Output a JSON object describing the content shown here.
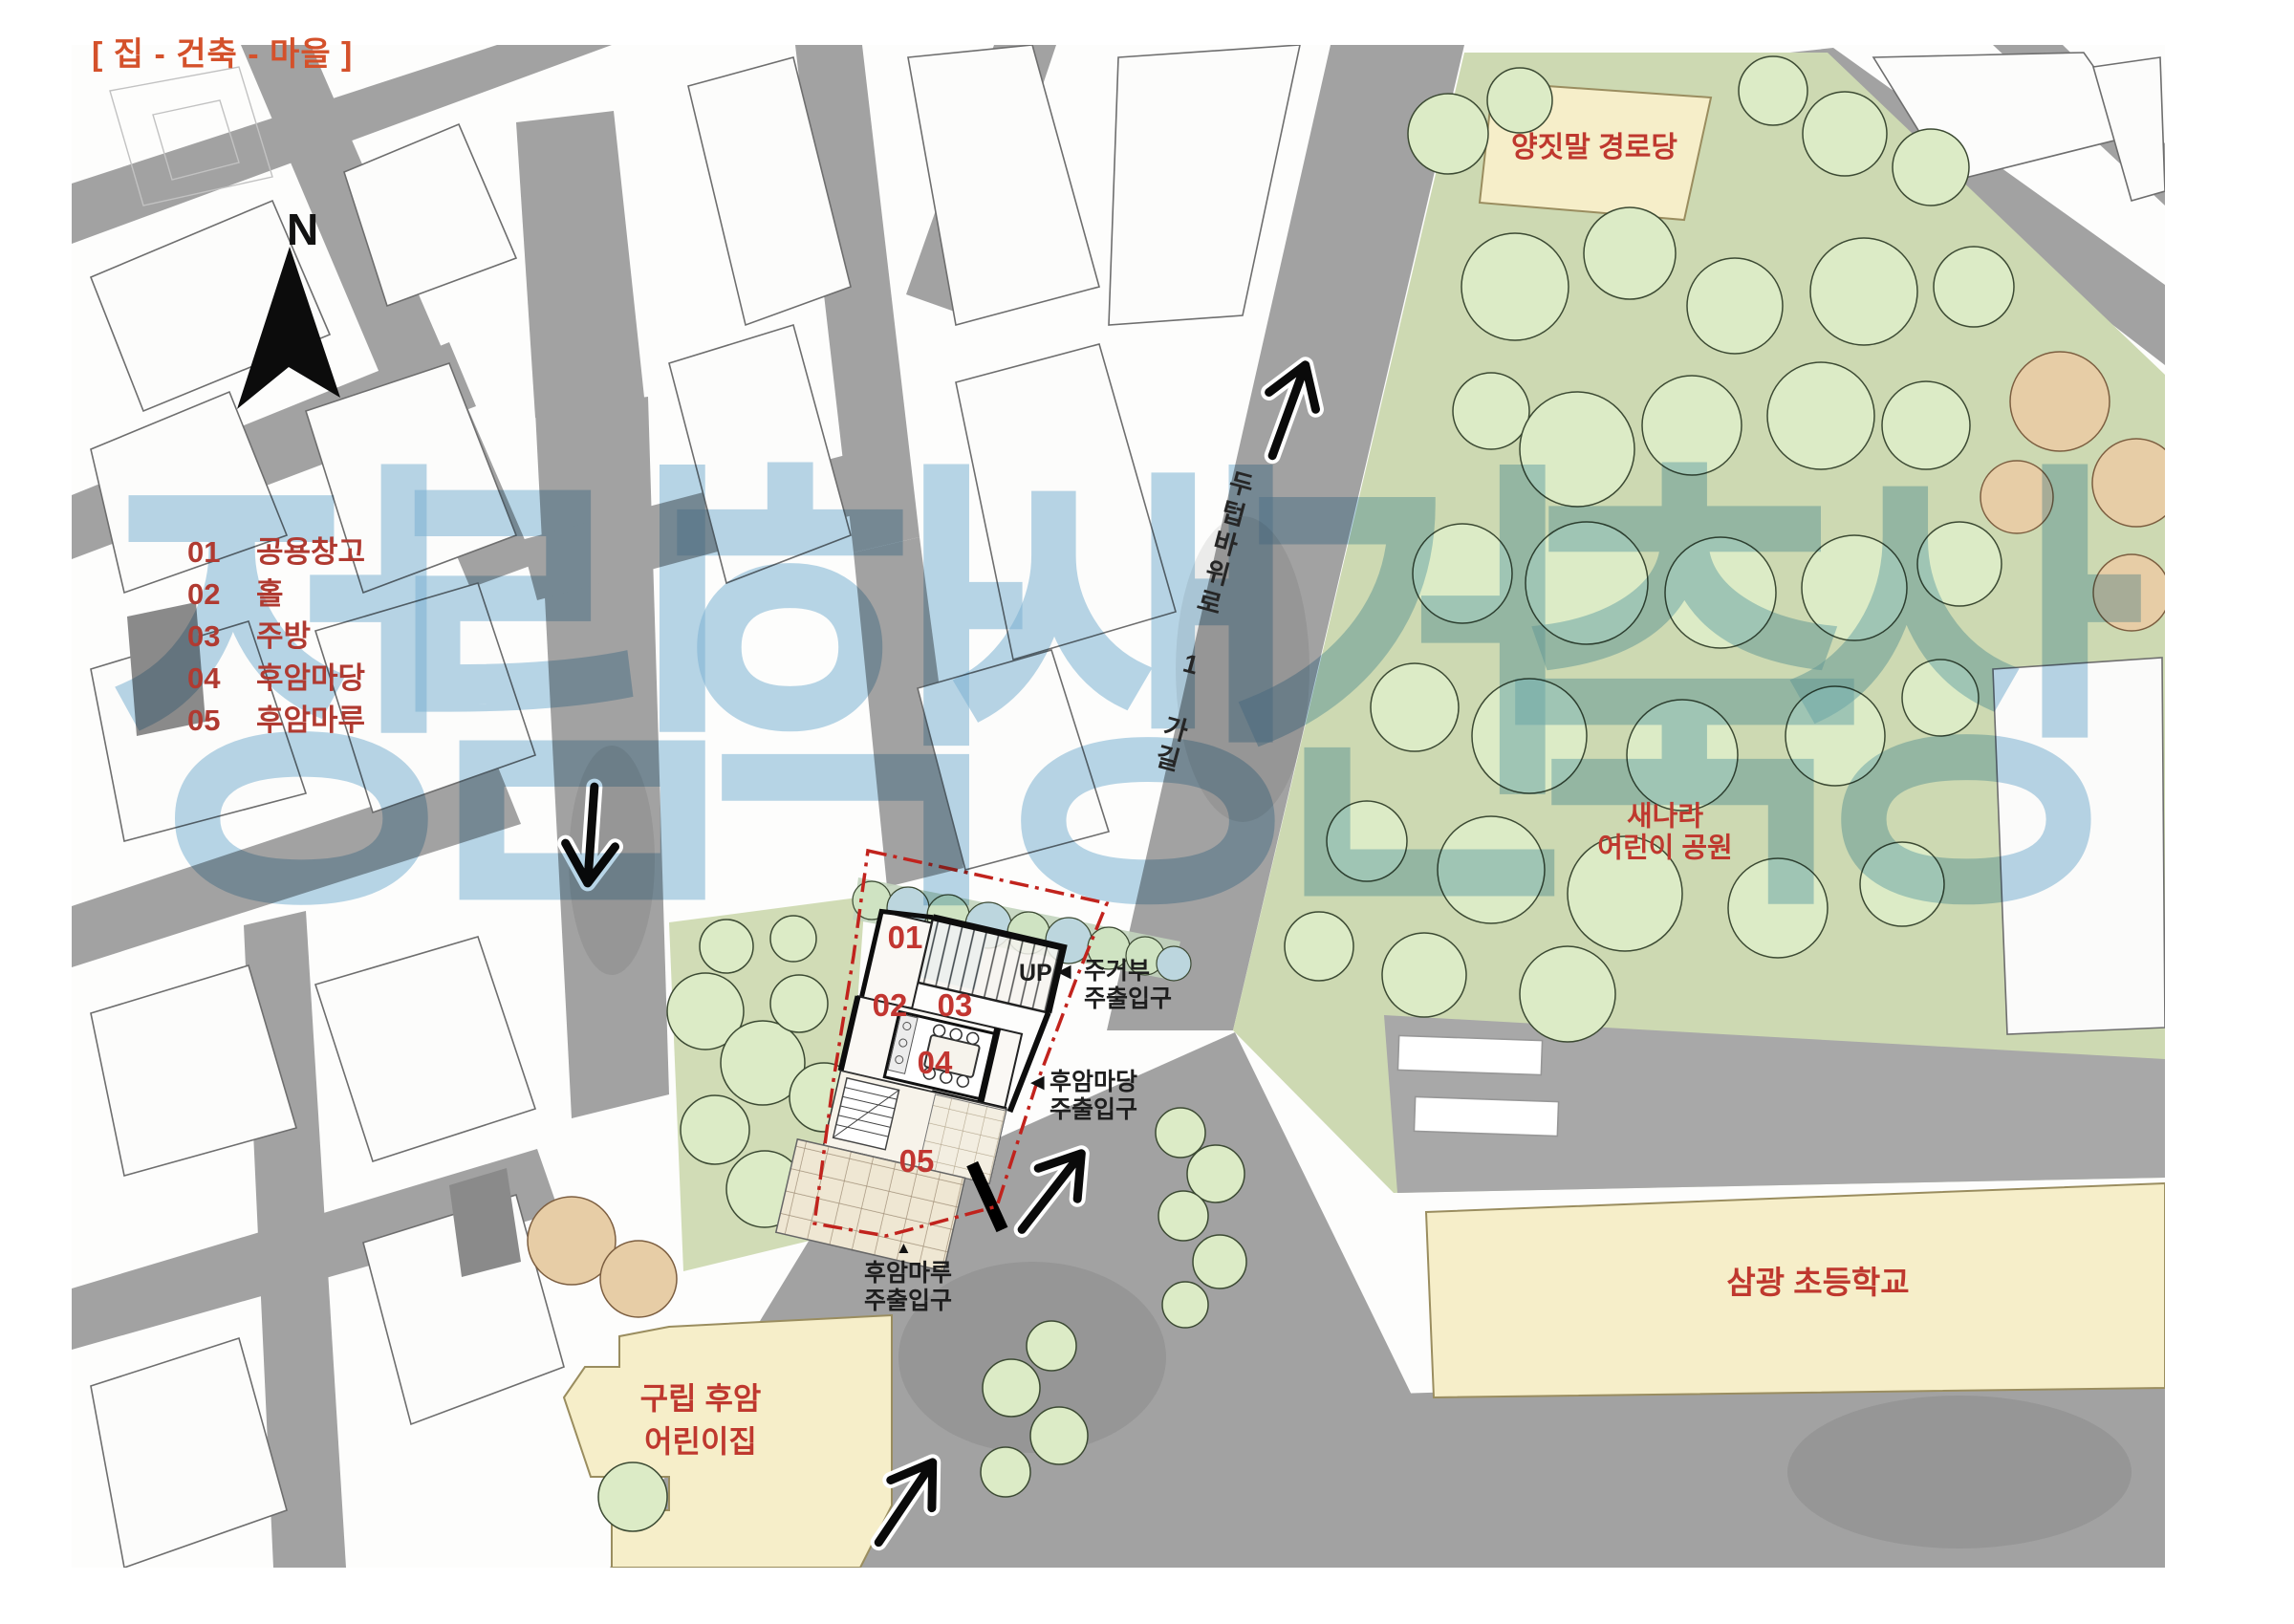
{
  "title": "[ 집 - 건축 - 마을 ]",
  "watermark": "정림학생건축상",
  "compass": {
    "north_label": "N"
  },
  "legend": {
    "items": [
      {
        "num": "01",
        "label": "공용창고"
      },
      {
        "num": "02",
        "label": "홀"
      },
      {
        "num": "03",
        "label": "주방"
      },
      {
        "num": "04",
        "label": "후암마당"
      },
      {
        "num": "05",
        "label": "후암마루"
      }
    ]
  },
  "plan": {
    "up_label": "UP",
    "markers": [
      "01",
      "02",
      "03",
      "04",
      "05"
    ],
    "entrance_residential": {
      "line1": "주거부",
      "line2": "주출입구",
      "marker": "◀"
    },
    "entrance_madang": {
      "line1": "후암마당",
      "line2": "주출입구",
      "marker": "◀"
    },
    "entrance_maru": {
      "line1": "후암마루",
      "line2": "주출입구",
      "marker": "▲"
    }
  },
  "map_labels": {
    "road_name": "두텁바위로 1 가길",
    "senior_center": "양짓말 경로당",
    "park_line1": "새나라",
    "park_line2": "어린이 공원",
    "school": "삼광 초등학교",
    "daycare_line1": "구립 후암",
    "daycare_line2": "어린이집"
  },
  "colors": {
    "title_orange": "#d4512b",
    "label_red": "#b03a31",
    "num_red": "#c23631",
    "map_red": "#bf382e",
    "text_dark": "#1e1e1e",
    "boundary_red": "#c1231d",
    "road_gray": "#a2a2a2",
    "park_green": "#cdd9b2",
    "tree_green": "#dcebc6",
    "tan": "#e7cda6",
    "cream": "#f6eec9",
    "watermark_blue": "rgba(125,180,213,0.55)"
  }
}
